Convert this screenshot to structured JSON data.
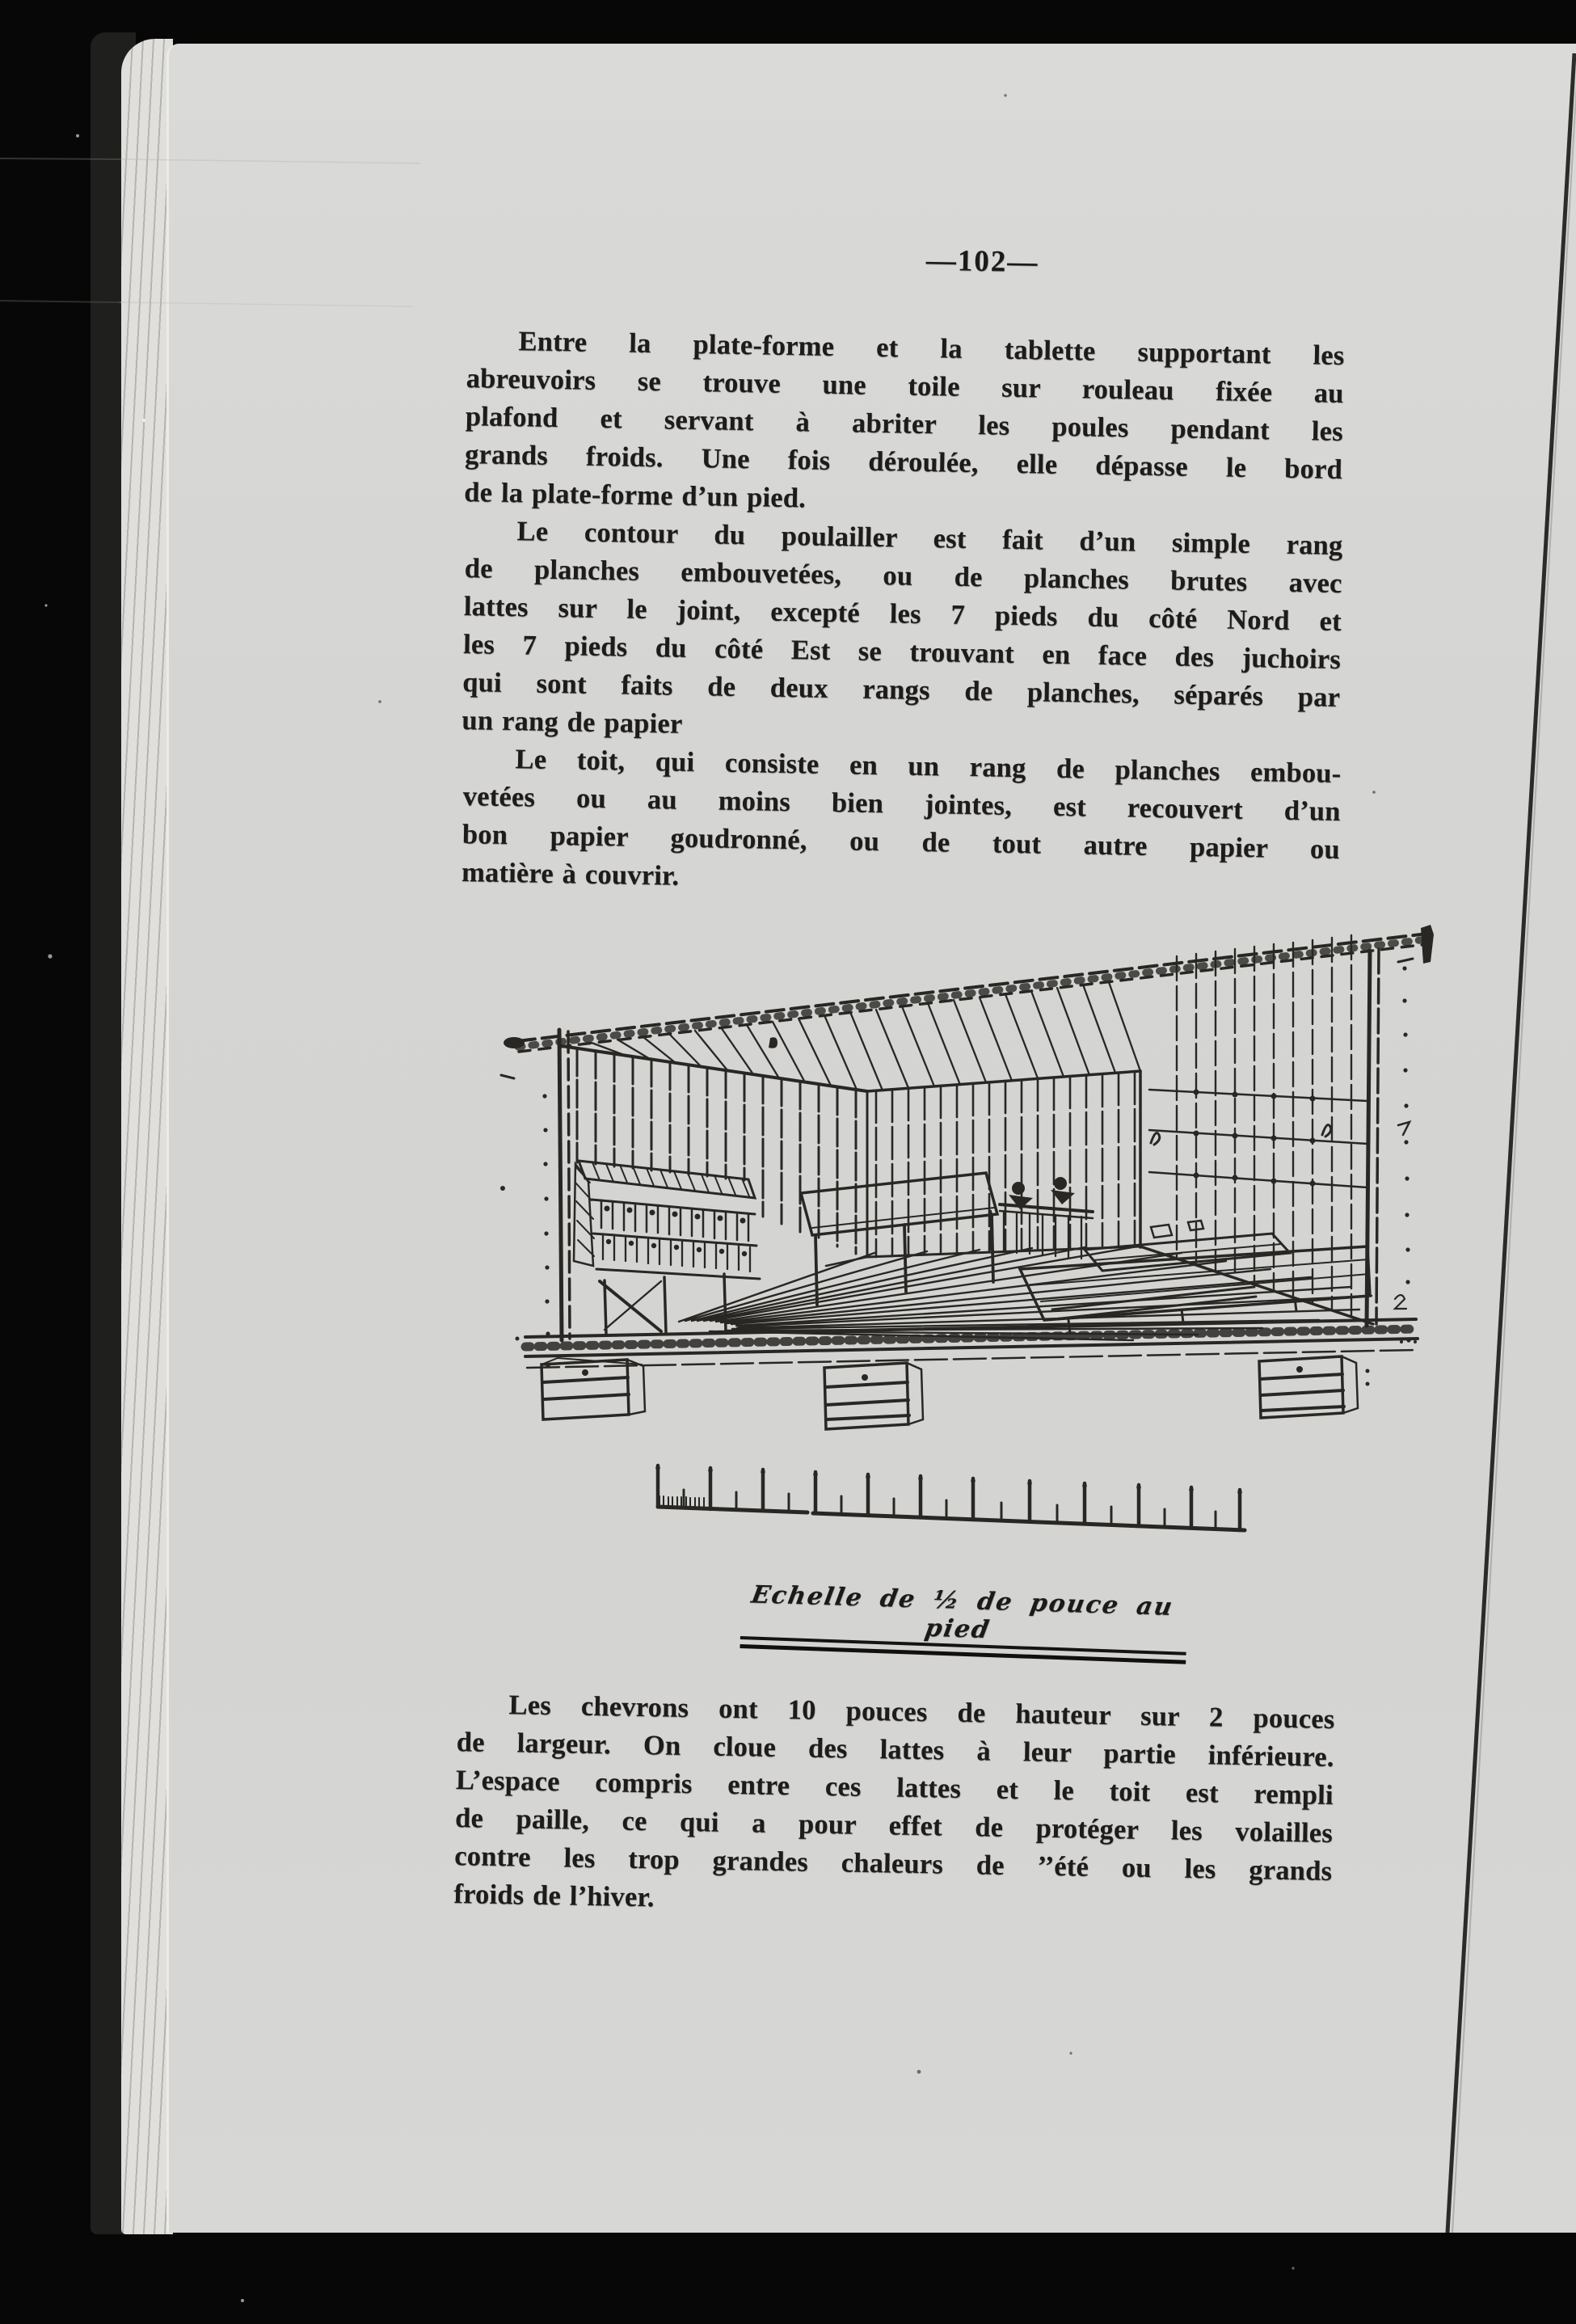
{
  "doc": {
    "page_number": "—102—",
    "body": {
      "p1": [
        "Entre la plate-forme et la tablette supportant les",
        "abreuvoirs se trouve une toile sur rouleau fixée au",
        "plafond et servant à abriter les poules pendant les",
        "grands froids.  Une fois déroulée, elle dépasse le bord",
        "de la plate-forme d’un pied."
      ],
      "p2": [
        "Le contour du poulailler est fait d’un simple rang",
        "de planches embouvetées, ou de planches brutes avec",
        "lattes sur le joint, excepté les 7 pieds du côté Nord et",
        "les 7 pieds du côté Est se trouvant en face des juchoirs",
        "qui sont faits de deux rangs de planches, séparés par",
        "un rang de papier"
      ],
      "p3": [
        "Le toit, qui consiste en un rang de planches embou-",
        "vetées ou au moins bien jointes, est recouvert d’un",
        "bon papier goudronné, ou de tout autre papier ou",
        "matière à couvrir."
      ],
      "p4": [
        "Les chevrons ont 10 pouces de hauteur sur 2 pouces",
        "de largeur.   On cloue des lattes à leur partie inférieure.",
        "L’espace compris entre ces lattes et le toit est rempli",
        "de paille, ce qui a pour effet de protéger les volailles",
        "contre les trop grandes chaleurs de ’’été ou les grands",
        "froids de l’hiver."
      ]
    },
    "figure": {
      "caption": "Echelle de ½ de pouce au pied"
    }
  }
}
